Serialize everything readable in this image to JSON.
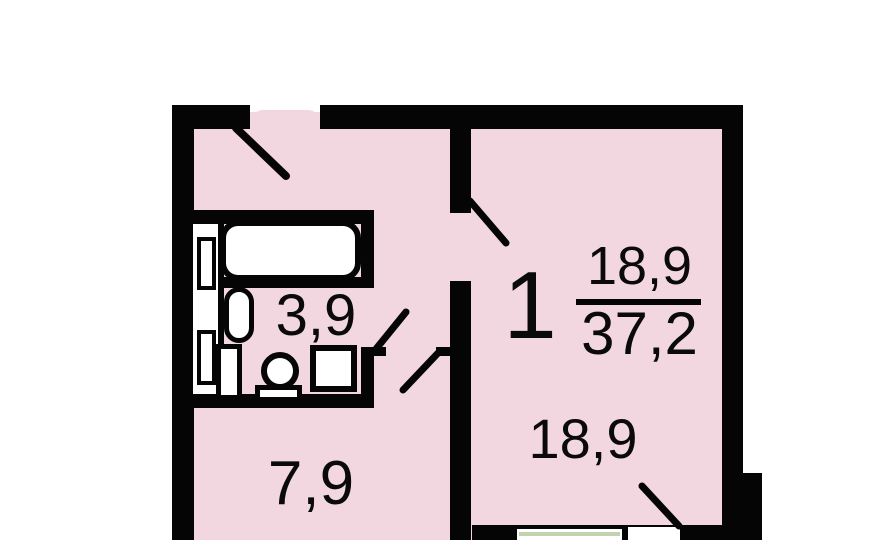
{
  "floorplan": {
    "labels": {
      "room_count": "1",
      "living_area": "18,9",
      "total_area": "37,2",
      "living_room_area": "18,9",
      "kitchen_area": "7,9",
      "bathroom_area": "3,9"
    },
    "colors": {
      "background": "#ffffff",
      "wall": "#050505",
      "room_fill": "#f2d7e0",
      "fixture_fill": "#ffffff",
      "window_line": "#c3d2ae"
    }
  }
}
